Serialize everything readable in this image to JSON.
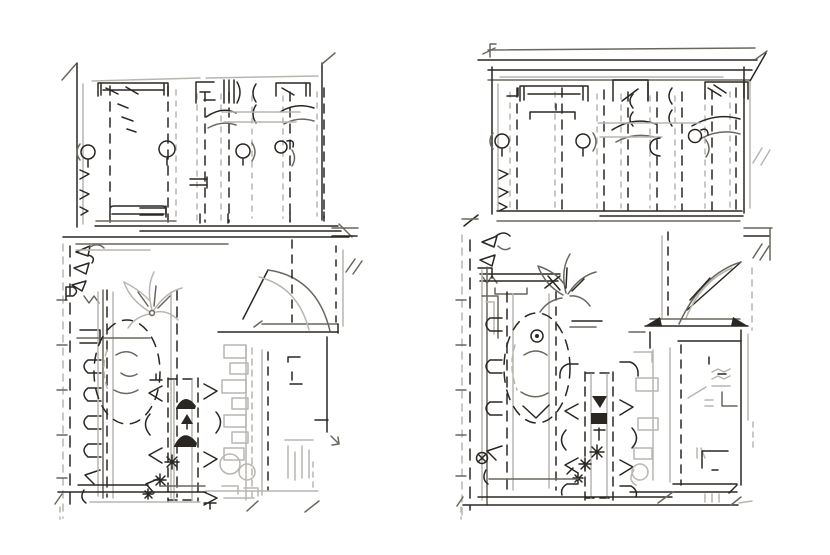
{
  "document": {
    "kind": "hand-drawn architectural floor plan sketch",
    "description": "Two rough pen-sketched apartment floor plans side by side on a white sheet. Each plan has a bedroom wing at top with dashed stall partitions, beds with pillows, blanket swooshes, round columns and wall hooks, and a living wing below with an oval dashed rug, a potted plant, a dining table with chairs and dark centerpiece marks, flower asterisks, a light-grey kitchen counter block, a door swing arc and bold bottom walls.",
    "panels": [
      {
        "id": "floor-plan-left",
        "position": "left",
        "zones": [
          {
            "name": "bedroom-wing",
            "elements": [
              "left-wall",
              "right-wall",
              "stall-partitions-dashed",
              "double-bed-left",
              "wardrobe-shelves",
              "slatted-shelf",
              "double-bed-right",
              "blanket-swooshes",
              "round-columns",
              "wall-hooks",
              "bench",
              "divider-wall"
            ]
          },
          {
            "name": "living-wing",
            "elements": [
              "entry-hooks",
              "seat-row",
              "oval-rug",
              "potted-plant",
              "dining-table",
              "dining-chairs",
              "centerpiece-domes",
              "flower-marks",
              "kitchen-counter",
              "sink-circles",
              "door-swing",
              "balcony-stub",
              "bottom-wall"
            ]
          }
        ]
      },
      {
        "id": "floor-plan-right",
        "position": "right",
        "zones": [
          {
            "name": "bedroom-wing",
            "elements": [
              "top-double-wall",
              "left-wall",
              "right-wall",
              "stall-partitions-dashed",
              "double-bed-left",
              "storage-box",
              "double-bed-right",
              "blanket-swooshes",
              "round-columns",
              "wall-hooks",
              "divider-wall"
            ]
          },
          {
            "name": "living-wing",
            "elements": [
              "entry-hooks",
              "seat-row",
              "oval-rug",
              "rug-medallion",
              "potted-plant",
              "console-table",
              "dining-table",
              "dining-chairs",
              "centerpiece-tray",
              "flower-marks",
              "target-circle",
              "kitchen-block",
              "door-swing",
              "balcony-stub",
              "bottom-wall"
            ]
          }
        ]
      }
    ]
  },
  "palette": {
    "background": "#ffffff",
    "ink": "#2a2722",
    "mid": "#6a675f",
    "faint": "#b9b6b0"
  }
}
